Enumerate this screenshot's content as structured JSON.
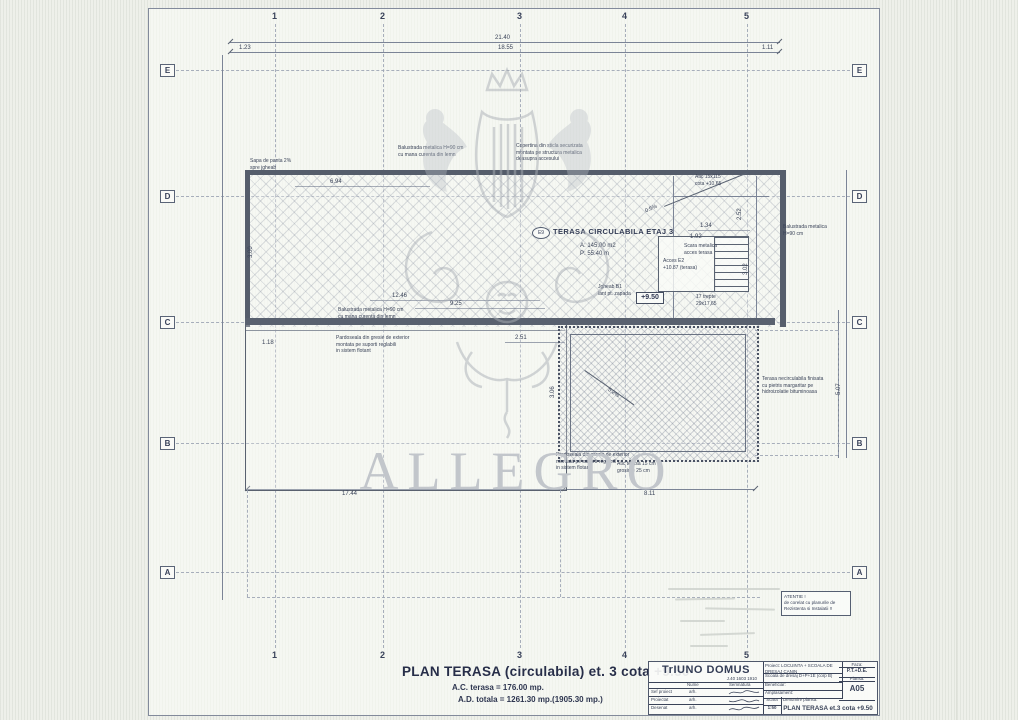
{
  "grid": {
    "numbers": [
      "1",
      "2",
      "3",
      "4",
      "5"
    ],
    "letters": [
      "E",
      "D",
      "C",
      "B",
      "A"
    ]
  },
  "plan": {
    "room_tag": "E9",
    "room_title": "TERASA CIRCULABILA ETAJ 3",
    "room_area": "A: 145.00 m2",
    "room_perim": "P: 55.40 m",
    "elevation": "+9.50",
    "stairs_count": "17 trepte\n29x17,65",
    "stair_label1": "Scara metalica\nacces terasa",
    "stair_label2": "Acces E2\n+10.87 (terasa)"
  },
  "dims": {
    "top_total": "21.40",
    "top_left": "1.23",
    "top_mid": "18.55",
    "top_right": "1.11",
    "w_694": "6.94",
    "w_1246": "12.46",
    "w_925": "9.25",
    "w_251": "2.51",
    "w_134": "1.34",
    "w_192": "1.92",
    "w_118": "1.18",
    "bottom_left": "17.44",
    "bottom_right": "8.11",
    "v_300": "3.00",
    "v_252": "2.52",
    "v_302": "3.02",
    "v_306": "3.06",
    "v_507": "5.07",
    "slope1": "5.2%",
    "slope2": "0.5%"
  },
  "notes": {
    "balustrade_top": "Balustrada metalica H=90 cm\ncu mana curenta din lemn",
    "copertina": "Copertina din sticla securizata\nmontata pe structura metalica\ndeasupra accesului",
    "sapa": "Sapa de panta 2%\nspre jgheab",
    "jgheab": "Jgheab B1\nlant pt. zapada",
    "atic_top": "Atic 15x115\ncota +10.65",
    "balustrade_mid": "Balustrada metalica H=90 cm\ncu mana curenta din lemn",
    "pardoseala": "Pardoseala din gresie de exterior\nmontata pe suporti reglabili\nin sistem flotant",
    "terasa_necirc": "Terasa necirculabila finisata\ncu pietris margaritar pe\nhidroizolatie bituminoasa",
    "atic_bottom": "Atic terasa 15 cm\ngrosime 25 cm",
    "balustrade_right": "Balustrada metalica\nH=90 cm",
    "atentie": "ATENTIE !\nde corelat cu planurile de\nRezistenta si Instalatii !!"
  },
  "footer": {
    "title": "PLAN TERASA (circulabila) et. 3 cota +9.50",
    "ac": "A.C. terasa  =  176.00 mp.",
    "ad": "A.D. totala = 1261.30 mp.(1905.30 mp.)"
  },
  "titleblock": {
    "firm": "TrIUNO DOMUS",
    "firm_reg": "J.40 1603 1910",
    "col_nume": "Nume",
    "col_semnatura": "Semnatura",
    "sig_rows": [
      {
        "role": "Sef proiect",
        "name": "arh."
      },
      {
        "role": "Proiectat",
        "name": "arh."
      },
      {
        "role": "Desenat",
        "name": "arh."
      }
    ],
    "proiect_label": "Proiect:",
    "proiect": "LOCUINTA + SCOALA DE DRESAJ CANIN",
    "proiect_sub": "Scoala de dresaj D+P+1E (corp B)",
    "beneficiar_label": "Beneficiar:",
    "amplasament_label": "Amplasament:",
    "faza_label": "Faza:",
    "faza": "P.T.+D.E.",
    "plansa_label": "Plansa:",
    "plansa": "A05",
    "scara_label": "Scara",
    "scara": "1:50",
    "data_label": "Data",
    "denumire_label": "Denumire plansa:",
    "plan_name": "PLAN TERASA et.3 cota +9.50"
  },
  "watermark": {
    "text": "ALLEGRO"
  }
}
